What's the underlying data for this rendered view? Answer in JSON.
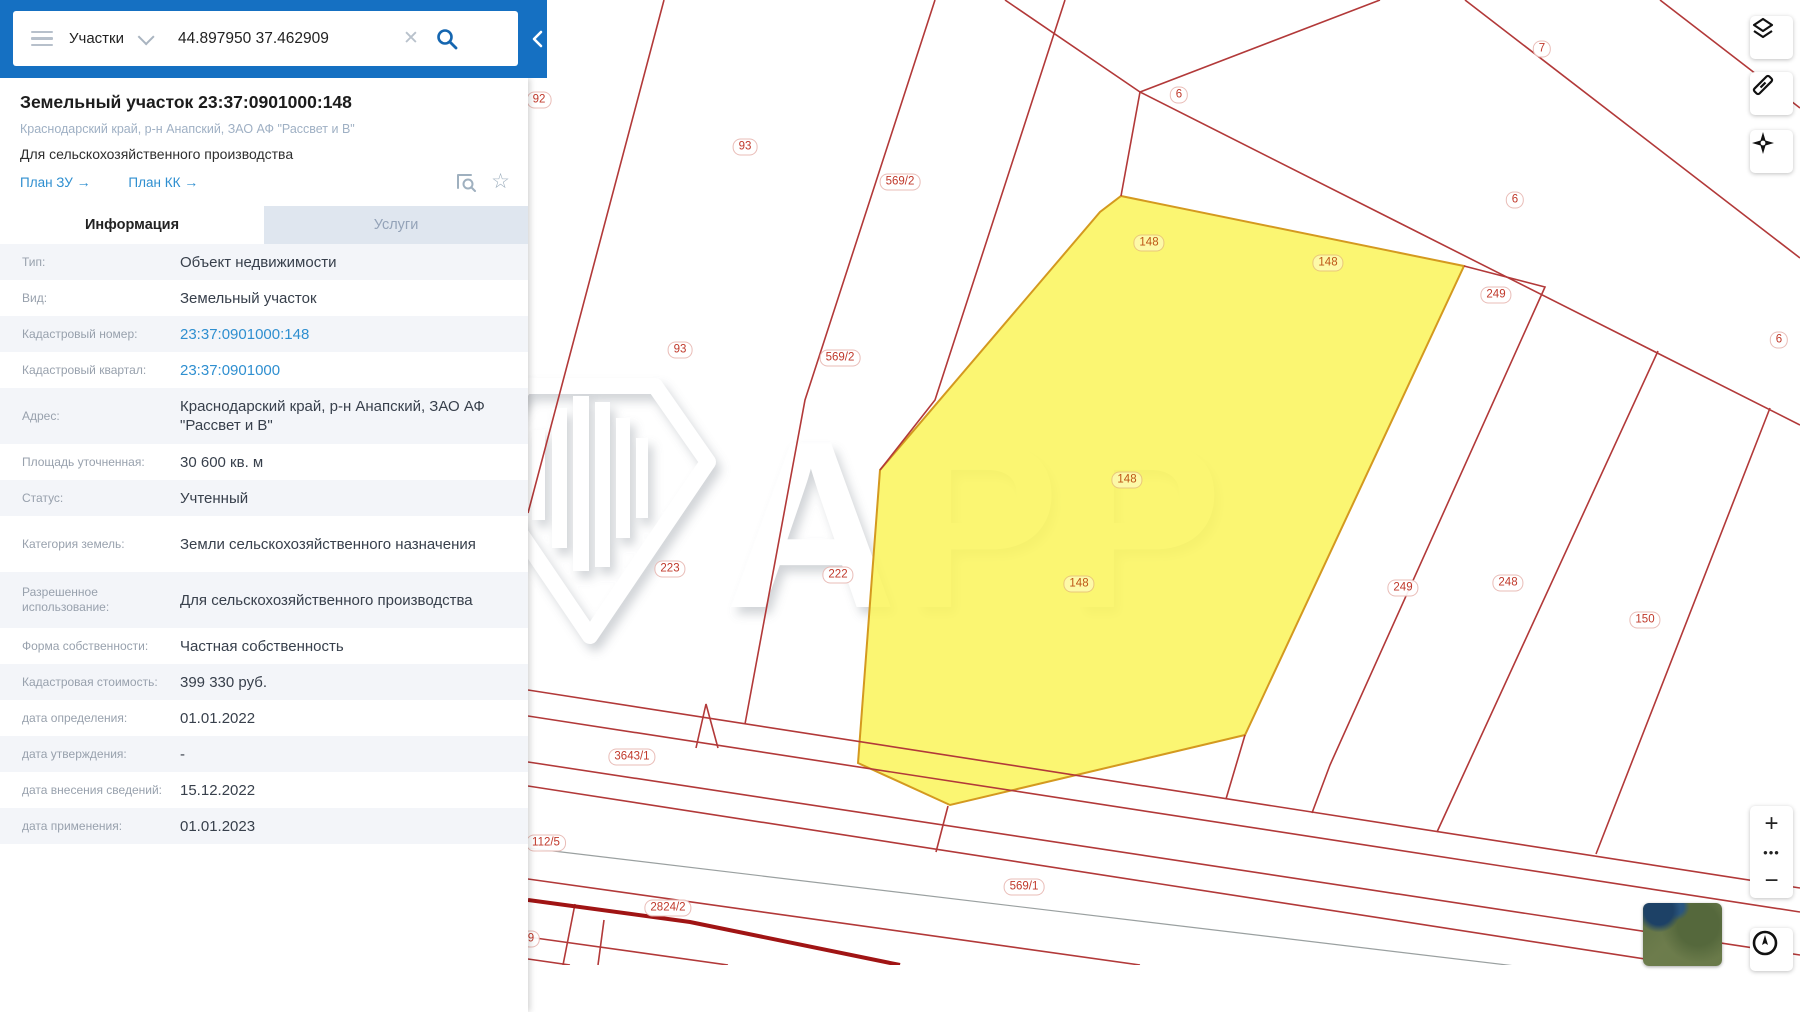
{
  "colors": {
    "topbar_blue": "#1570c2",
    "map_line_red": "#b23939",
    "thick_road_red": "#a01414",
    "parcel_yellow": "#fbf55e",
    "link_blue": "#2f8fd0"
  },
  "topbar": {
    "category_label": "Участки",
    "search_value": "44.897950 37.462909"
  },
  "panel": {
    "title": "Земельный участок 23:37:0901000:148",
    "subtitle": "Краснодарский край, р-н Анапский, ЗАО АФ \"Рассвет и В\"",
    "purpose": "Для сельскохозяйственного производства",
    "link_plan_zu": "План ЗУ",
    "link_plan_kk": "План КК",
    "tab_info": "Информация",
    "tab_services": "Услуги",
    "rows": [
      {
        "label": "Тип:",
        "value": "Объект недвижимости"
      },
      {
        "label": "Вид:",
        "value": "Земельный участок"
      },
      {
        "label": "Кадастровый номер:",
        "value": "23:37:0901000:148",
        "link": true
      },
      {
        "label": "Кадастровый квартал:",
        "value": "23:37:0901000",
        "link": true
      },
      {
        "label": "Адрес:",
        "value": "Краснодарский край, р-н Анапский, ЗАО АФ \"Рассвет и В\"",
        "tall": true
      },
      {
        "label": "Площадь уточненная:",
        "value": "30 600 кв. м"
      },
      {
        "label": "Статус:",
        "value": "Учтенный"
      },
      {
        "label": "Категория земель:",
        "value": "Земли сельскохозяйственного назначения",
        "tall": true
      },
      {
        "label": "Разрешенное использование:",
        "value": "Для сельскохозяйственного производства",
        "tall": true
      },
      {
        "label": "Форма собственности:",
        "value": "Частная собственность"
      },
      {
        "label": "Кадастровая стоимость:",
        "value": "399 330 руб."
      },
      {
        "label": "дата определения:",
        "value": "01.01.2022"
      },
      {
        "label": "дата утверждения:",
        "value": "-"
      },
      {
        "label": "дата внесения сведений:",
        "value": "15.12.2022"
      },
      {
        "label": "дата применения:",
        "value": "01.01.2023"
      }
    ]
  },
  "map": {
    "watermark": "АРР",
    "zoom_in": "+",
    "zoom_dots": "•••",
    "zoom_out": "−",
    "labels": [
      {
        "text": "92",
        "x": 539,
        "y": 100
      },
      {
        "text": "93",
        "x": 745,
        "y": 147
      },
      {
        "text": "569/2",
        "x": 900,
        "y": 182
      },
      {
        "text": "93",
        "x": 680,
        "y": 350
      },
      {
        "text": "569/2",
        "x": 840,
        "y": 358
      },
      {
        "text": "7",
        "x": 1542,
        "y": 49
      },
      {
        "text": "6",
        "x": 1179,
        "y": 95
      },
      {
        "text": "6",
        "x": 1515,
        "y": 200
      },
      {
        "text": "249",
        "x": 1496,
        "y": 295
      },
      {
        "text": "6",
        "x": 1779,
        "y": 340
      },
      {
        "text": "148",
        "x": 1149,
        "y": 243,
        "yellow": true
      },
      {
        "text": "148",
        "x": 1328,
        "y": 263,
        "yellow": true
      },
      {
        "text": "148",
        "x": 1127,
        "y": 480,
        "yellow": true
      },
      {
        "text": "148",
        "x": 1079,
        "y": 584,
        "yellow": true
      },
      {
        "text": "223",
        "x": 670,
        "y": 569
      },
      {
        "text": "222",
        "x": 838,
        "y": 575
      },
      {
        "text": "249",
        "x": 1403,
        "y": 588
      },
      {
        "text": "248",
        "x": 1508,
        "y": 583
      },
      {
        "text": "150",
        "x": 1645,
        "y": 620
      },
      {
        "text": "3643/1",
        "x": 632,
        "y": 757
      },
      {
        "text": "112/5",
        "x": 546,
        "y": 843
      },
      {
        "text": "569/1",
        "x": 1024,
        "y": 887
      },
      {
        "text": "2824/2",
        "x": 668,
        "y": 908
      },
      {
        "text": "9",
        "x": 531,
        "y": 939
      }
    ]
  }
}
